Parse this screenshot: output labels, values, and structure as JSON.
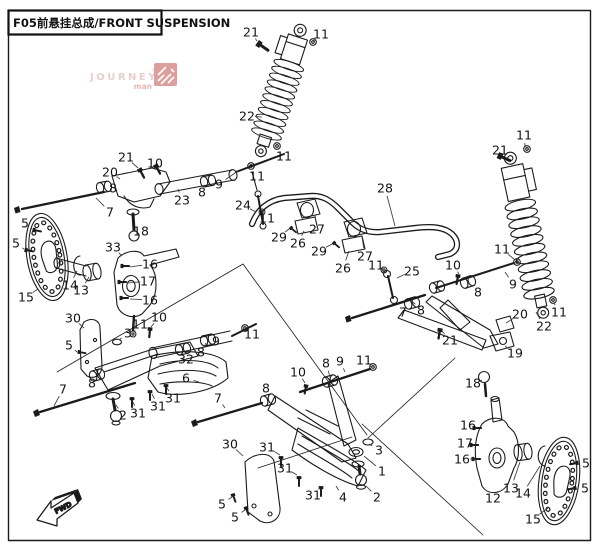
{
  "page": {
    "title": "F05前悬挂总成/FRONT SUSPENSION",
    "background": "#ffffff",
    "line_color": "#1b1b1b"
  },
  "watermark": {
    "line1": "JOURNEY",
    "line2": "man",
    "registered": "®",
    "text_color": "#d9aeab",
    "accent_color": "#d98884",
    "icon_color": "#c4615d"
  },
  "direction_indicator": {
    "label": "FWD"
  },
  "diagram": {
    "description": "Exploded parts view of ATV front suspension: two coil-over shock absorbers, upper and lower A-arms, steering knuckles, brake discs, stabilizer bar with links, and fasteners",
    "callouts": [
      {
        "n": "21",
        "x": 251,
        "y": 32,
        "tx": 257,
        "ty": 41
      },
      {
        "n": "11",
        "x": 321,
        "y": 34,
        "tx": 314,
        "ty": 41
      },
      {
        "n": "22",
        "x": 247,
        "y": 116,
        "tx": 262,
        "ty": 117
      },
      {
        "n": "11",
        "x": 284,
        "y": 156,
        "tx": 279,
        "ty": 149
      },
      {
        "n": "21",
        "x": 126,
        "y": 157,
        "tx": 138,
        "ty": 168
      },
      {
        "n": "10",
        "x": 155,
        "y": 163,
        "tx": 157,
        "ty": 167
      },
      {
        "n": "20",
        "x": 110,
        "y": 172,
        "tx": 120,
        "ty": 179
      },
      {
        "n": "8",
        "x": 113,
        "y": 188,
        "tx": 106,
        "ty": 186
      },
      {
        "n": "23",
        "x": 182,
        "y": 200,
        "tx": 178,
        "ty": 189
      },
      {
        "n": "8",
        "x": 202,
        "y": 192,
        "tx": 208,
        "ty": 184
      },
      {
        "n": "9",
        "x": 219,
        "y": 184,
        "tx": 238,
        "ty": 171
      },
      {
        "n": "11",
        "x": 257,
        "y": 176,
        "tx": 252,
        "ty": 169
      },
      {
        "n": "7",
        "x": 110,
        "y": 212,
        "tx": 96,
        "ty": 198
      },
      {
        "n": "18",
        "x": 141,
        "y": 231,
        "tx": 135,
        "ty": 230
      },
      {
        "n": "24",
        "x": 243,
        "y": 205,
        "tx": 256,
        "ty": 212
      },
      {
        "n": "33",
        "x": 113,
        "y": 247,
        "tx": 122,
        "ty": 256
      },
      {
        "n": "5",
        "x": 25,
        "y": 223,
        "tx": 32,
        "ty": 229
      },
      {
        "n": "5",
        "x": 16,
        "y": 243,
        "tx": 24,
        "ty": 249
      },
      {
        "n": "14",
        "x": 70,
        "y": 285,
        "tx": 77,
        "ty": 271
      },
      {
        "n": "13",
        "x": 81,
        "y": 290,
        "tx": 89,
        "ty": 277
      },
      {
        "n": "15",
        "x": 26,
        "y": 297,
        "tx": 38,
        "ty": 289
      },
      {
        "n": "16",
        "x": 150,
        "y": 264,
        "tx": 130,
        "ty": 267
      },
      {
        "n": "17",
        "x": 148,
        "y": 281,
        "tx": 128,
        "ty": 283
      },
      {
        "n": "16",
        "x": 150,
        "y": 300,
        "tx": 130,
        "ty": 299
      },
      {
        "n": "10",
        "x": 159,
        "y": 317,
        "tx": 151,
        "ty": 327
      },
      {
        "n": "11",
        "x": 140,
        "y": 324,
        "tx": 134,
        "ty": 332
      },
      {
        "n": "30",
        "x": 73,
        "y": 318,
        "tx": 84,
        "ty": 328
      },
      {
        "n": "3",
        "x": 128,
        "y": 333,
        "tx": 119,
        "ty": 340
      },
      {
        "n": "5",
        "x": 69,
        "y": 345,
        "tx": 77,
        "ty": 352
      },
      {
        "n": "7",
        "x": 63,
        "y": 389,
        "tx": 54,
        "ty": 406
      },
      {
        "n": "8",
        "x": 92,
        "y": 383,
        "tx": 97,
        "ty": 376
      },
      {
        "n": "2",
        "x": 123,
        "y": 415,
        "tx": 116,
        "ty": 405
      },
      {
        "n": "31",
        "x": 138,
        "y": 413,
        "tx": 133,
        "ty": 402
      },
      {
        "n": "31",
        "x": 158,
        "y": 406,
        "tx": 152,
        "ty": 394
      },
      {
        "n": "31",
        "x": 173,
        "y": 398,
        "tx": 167,
        "ty": 388
      },
      {
        "n": "6",
        "x": 186,
        "y": 378,
        "tx": 199,
        "ty": 382
      },
      {
        "n": "32",
        "x": 186,
        "y": 359,
        "tx": 184,
        "ty": 352
      },
      {
        "n": "8",
        "x": 201,
        "y": 352,
        "tx": 206,
        "ty": 343
      },
      {
        "n": "9",
        "x": 216,
        "y": 341,
        "tx": 221,
        "ty": 334
      },
      {
        "n": "11",
        "x": 252,
        "y": 334,
        "tx": 246,
        "ty": 330
      },
      {
        "n": "28",
        "x": 385,
        "y": 188,
        "tx": 395,
        "ty": 226
      },
      {
        "n": "11",
        "x": 267,
        "y": 218,
        "tx": 262,
        "ty": 213
      },
      {
        "n": "29",
        "x": 279,
        "y": 237,
        "tx": 289,
        "ty": 229
      },
      {
        "n": "26",
        "x": 298,
        "y": 243,
        "tx": 304,
        "ty": 231
      },
      {
        "n": "27",
        "x": 317,
        "y": 229,
        "tx": 315,
        "ty": 215
      },
      {
        "n": "29",
        "x": 319,
        "y": 251,
        "tx": 332,
        "ty": 244
      },
      {
        "n": "26",
        "x": 343,
        "y": 268,
        "tx": 349,
        "ty": 251
      },
      {
        "n": "27",
        "x": 365,
        "y": 256,
        "tx": 362,
        "ty": 237
      },
      {
        "n": "11",
        "x": 376,
        "y": 265,
        "tx": 384,
        "ty": 272
      },
      {
        "n": "25",
        "x": 412,
        "y": 271,
        "tx": 397,
        "ty": 278
      },
      {
        "n": "10",
        "x": 453,
        "y": 265,
        "tx": 459,
        "ty": 274
      },
      {
        "n": "11",
        "x": 502,
        "y": 249,
        "tx": 515,
        "ty": 260
      },
      {
        "n": "9",
        "x": 513,
        "y": 284,
        "tx": 505,
        "ty": 272
      },
      {
        "n": "8",
        "x": 478,
        "y": 292,
        "tx": 470,
        "ty": 284
      },
      {
        "n": "7",
        "x": 403,
        "y": 312,
        "tx": 400,
        "ty": 304
      },
      {
        "n": "8",
        "x": 421,
        "y": 310,
        "tx": 413,
        "ty": 302
      },
      {
        "n": "21",
        "x": 450,
        "y": 340,
        "tx": 442,
        "ty": 331
      },
      {
        "n": "19",
        "x": 515,
        "y": 353,
        "tx": 505,
        "ty": 346
      },
      {
        "n": "20",
        "x": 520,
        "y": 314,
        "tx": 506,
        "ty": 323
      },
      {
        "n": "22",
        "x": 544,
        "y": 326,
        "tx": 536,
        "ty": 312
      },
      {
        "n": "11",
        "x": 559,
        "y": 312,
        "tx": 554,
        "ty": 303
      },
      {
        "n": "11",
        "x": 524,
        "y": 135,
        "tx": 525,
        "ty": 146
      },
      {
        "n": "21",
        "x": 500,
        "y": 150,
        "tx": 503,
        "ty": 156
      },
      {
        "n": "18",
        "x": 473,
        "y": 383,
        "tx": 482,
        "ty": 380
      },
      {
        "n": "16",
        "x": 468,
        "y": 425,
        "tx": 477,
        "ty": 428
      },
      {
        "n": "17",
        "x": 465,
        "y": 443,
        "tx": 474,
        "ty": 446
      },
      {
        "n": "16",
        "x": 462,
        "y": 459,
        "tx": 476,
        "ty": 459
      },
      {
        "n": "12",
        "x": 493,
        "y": 498,
        "tx": 492,
        "ty": 490
      },
      {
        "n": "13",
        "x": 511,
        "y": 488,
        "tx": 520,
        "ty": 462
      },
      {
        "n": "14",
        "x": 523,
        "y": 493,
        "tx": 540,
        "ty": 466
      },
      {
        "n": "15",
        "x": 533,
        "y": 519,
        "tx": 548,
        "ty": 508
      },
      {
        "n": "5",
        "x": 586,
        "y": 463,
        "tx": 578,
        "ty": 466
      },
      {
        "n": "5",
        "x": 585,
        "y": 488,
        "tx": 576,
        "ty": 489
      },
      {
        "n": "30",
        "x": 230,
        "y": 444,
        "tx": 243,
        "ty": 456
      },
      {
        "n": "31",
        "x": 267,
        "y": 447,
        "tx": 280,
        "ty": 455
      },
      {
        "n": "31",
        "x": 285,
        "y": 468,
        "tx": 297,
        "ty": 475
      },
      {
        "n": "31",
        "x": 313,
        "y": 495,
        "tx": 320,
        "ty": 488
      },
      {
        "n": "4",
        "x": 343,
        "y": 497,
        "tx": 336,
        "ty": 486
      },
      {
        "n": "3",
        "x": 379,
        "y": 450,
        "tx": 369,
        "ty": 444
      },
      {
        "n": "1",
        "x": 382,
        "y": 471,
        "tx": 364,
        "ty": 456
      },
      {
        "n": "2",
        "x": 377,
        "y": 497,
        "tx": 366,
        "ty": 486
      },
      {
        "n": "5",
        "x": 222,
        "y": 504,
        "tx": 232,
        "ty": 497
      },
      {
        "n": "5",
        "x": 235,
        "y": 517,
        "tx": 245,
        "ty": 510
      },
      {
        "n": "7",
        "x": 218,
        "y": 398,
        "tx": 225,
        "ty": 408
      },
      {
        "n": "8",
        "x": 266,
        "y": 388,
        "tx": 269,
        "ty": 397
      },
      {
        "n": "10",
        "x": 298,
        "y": 372,
        "tx": 305,
        "ty": 383
      },
      {
        "n": "8",
        "x": 326,
        "y": 363,
        "tx": 330,
        "ty": 377
      },
      {
        "n": "9",
        "x": 340,
        "y": 361,
        "tx": 345,
        "ty": 372
      },
      {
        "n": "11",
        "x": 364,
        "y": 360,
        "tx": 371,
        "ty": 367
      }
    ]
  }
}
